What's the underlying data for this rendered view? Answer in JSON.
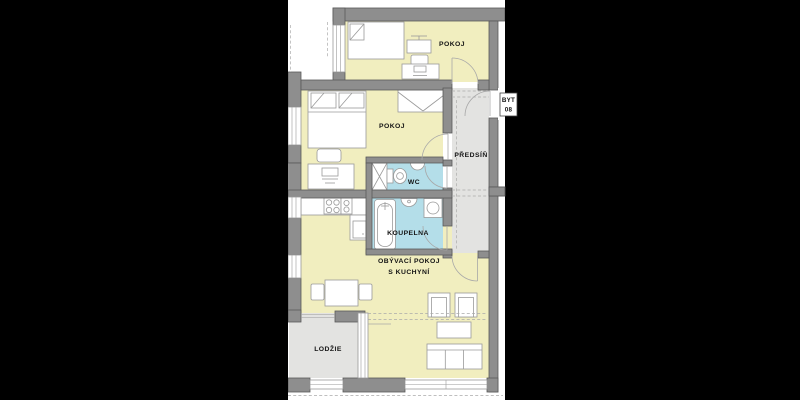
{
  "plan": {
    "title": "apartment floor plan",
    "unit_label": {
      "line1": "BYT",
      "line2": "08"
    },
    "rooms": {
      "pokoj_top": "POKOJ",
      "pokoj_middle": "POKOJ",
      "predsin": "PŘEDSÍŇ",
      "wc": "WC",
      "koupelna": "KOUPELNA",
      "obyvaci_line1": "OBÝVACÍ POKOJ",
      "obyvaci_line2": "S KUCHYNÍ",
      "lodzie": "LODŽIE"
    },
    "colors": {
      "letterbox": "#000000",
      "plan_background": "#ffffff",
      "room_fill": "#f1eebf",
      "wet_room_fill": "#b4dee9",
      "circulation_fill": "#e3e3e1",
      "wall_fill": "#8e8e8e",
      "wall_stroke": "#5a5a5a",
      "furniture_stroke": "#9a9a9a"
    }
  }
}
